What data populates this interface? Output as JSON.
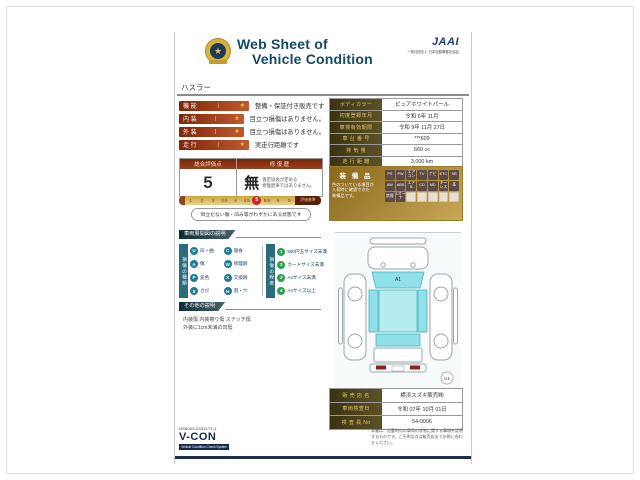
{
  "header": {
    "title_line1": "Web Sheet of",
    "title_line2": "Vehicle Condition",
    "jaai": "JAAI",
    "jaai_sub": "一般社団法人 日本自動車鑑定協会",
    "star": "★"
  },
  "model": "ハスラー",
  "ratings": [
    {
      "label": "機 能",
      "bar": "|",
      "star": "★",
      "desc": "整備・保証付き販売です"
    },
    {
      "label": "内 装",
      "bar": "|",
      "star": "★",
      "desc": "目立つ損傷はありません。"
    },
    {
      "label": "外 装",
      "bar": "|",
      "star": "★",
      "desc": "目立つ損傷はありません。"
    },
    {
      "label": "走 行",
      "bar": "|",
      "star": "★",
      "desc": "実走行距離です"
    }
  ],
  "info_rows": [
    {
      "label": "ボディカラー",
      "value": "ピュアホワイトパール"
    },
    {
      "label": "初度登録年月",
      "value": "令和 6年 11月"
    },
    {
      "label": "車検有効期限",
      "value": "令和 9年 11月 27日"
    },
    {
      "label": "車 台 番 号",
      "value": "***609"
    },
    {
      "label": "排 気 量",
      "value": "660 cc"
    },
    {
      "label": "走 行 距 離",
      "value": "3,000 km"
    }
  ],
  "evaluation": {
    "score_header": "総合評価点",
    "repair_header": "修 復 歴",
    "score": "5",
    "repair": "無",
    "repair_note1": "査定協会が定める",
    "repair_note2": "修復歴車ではありません。",
    "scale": [
      "1",
      "2",
      "3",
      "3.5",
      "4",
      "4.5",
      "5",
      "5.5",
      "6",
      "S"
    ],
    "scale_label": "評価基準",
    "condition_note": "目立たない傷・凹み等がわずかにある状態です"
  },
  "equipment": {
    "title": "装 備 品",
    "note1": "色のついている項目が",
    "note2": "入荷時に確認できた",
    "note3": "装備品です。",
    "badges": [
      "PS",
      "PW",
      "エアコン",
      "TV",
      "ナビ",
      "ETC",
      "SR",
      "AW",
      "ABS",
      "エアB",
      "CD",
      "MD",
      "キーレス",
      "革",
      "禁煙",
      "1オーナ"
    ]
  },
  "legend": {
    "banner": "車両展開図の説明",
    "type_title": "損傷の種類",
    "types": [
      {
        "code": "U",
        "label": "凹・曲"
      },
      {
        "code": "C",
        "label": "腐食"
      },
      {
        "code": "A",
        "label": "傷"
      },
      {
        "code": "W",
        "label": "修理跡"
      },
      {
        "code": "P",
        "label": "変色"
      },
      {
        "code": "X",
        "label": "交換跡"
      },
      {
        "code": "S",
        "label": "さび"
      },
      {
        "code": "H",
        "label": "割・穴"
      }
    ],
    "size_title": "損傷の程度",
    "sizes": [
      {
        "code": "1",
        "label": "500円玉サイズ未満"
      },
      {
        "code": "2",
        "label": "カードサイズ未満"
      },
      {
        "code": "3",
        "label": "A4サイズ未満"
      },
      {
        "code": "4",
        "label": "A4サイズ以上"
      }
    ]
  },
  "other": {
    "banner": "その他の説明",
    "line1": "内装傷 内装擦り傷 ステッチ傷",
    "line2": "外装に1cm未満の凹傷"
  },
  "diagram": {
    "marker": "A1",
    "spot": "U1"
  },
  "dealer_rows": [
    {
      "label": "販 売 店 名",
      "value": "横浜スズキ販売㈱"
    },
    {
      "label": "車両検査日",
      "value": "令和 07年 10月 01日"
    },
    {
      "label": "検 査 員 No",
      "value": "54-9006"
    }
  ],
  "footer": {
    "code": "NS8003-0031171-1",
    "vcon": "V-CON",
    "vcon_sub": "Vehicle Condition Check System",
    "fineprint": "本書は、記載時点の車両の状態に関する事項を証明するものです。ご不明な点は販売店までお問い合わせください。"
  },
  "colors": {
    "accent_teal": "#134a63",
    "maroon": "#8a2a0e",
    "gold": "#c9a227",
    "glass": "#8fe0e8",
    "green": "#2e9e4f"
  }
}
